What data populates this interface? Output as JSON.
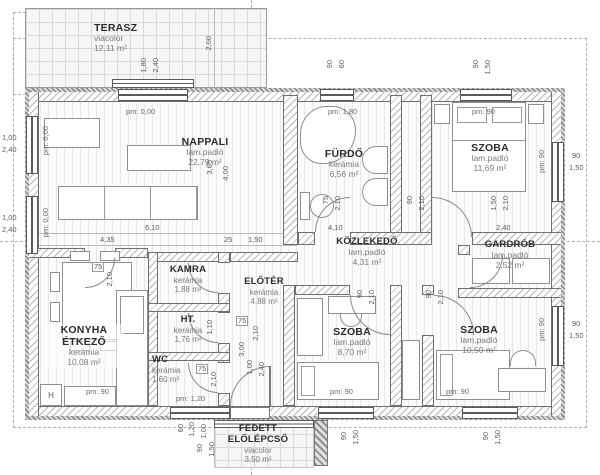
{
  "rooms": {
    "terasz": {
      "name": "TERASZ",
      "floor": "viacolor",
      "area": "12,11 m²"
    },
    "nappali": {
      "name": "NAPPALI",
      "floor": "lam.padló",
      "area": "22,79 m²"
    },
    "furdo": {
      "name": "FÜRDŐ",
      "floor": "kerámia",
      "area": "6,56 m²"
    },
    "szoba_jobb_felso": {
      "name": "SZOBA",
      "floor": "lam.padló",
      "area": "11,69 m²"
    },
    "kozlekedo": {
      "name": "KÖZLEKEDŐ",
      "floor": "lam.padló",
      "area": "4,31 m²"
    },
    "gardrob": {
      "name": "GARDRÓB",
      "floor": "lam.padló",
      "area": "2,52 m²"
    },
    "kamra": {
      "name": "KAMRA",
      "floor": "kerámia",
      "area": "1,88 m²"
    },
    "eloter": {
      "name": "ELŐTÉR",
      "floor": "kerámia",
      "area": "4,88 m²"
    },
    "ht": {
      "name": "HT.",
      "floor": "kerámia",
      "area": "1,76 m²"
    },
    "wc": {
      "name": "WC",
      "floor": "kerámia",
      "area": "1,60 m²"
    },
    "konyha": {
      "name": "KONYHA",
      "name2": "ÉTKEZŐ",
      "floor": "kerámia",
      "area": "10,08 m²"
    },
    "szoba_kozep": {
      "name": "SZOBA",
      "floor": "lam.padló",
      "area": "8,70 m²"
    },
    "szoba_jobb_also": {
      "name": "SZOBA",
      "floor": "lam.padló",
      "area": "10,50 m²"
    },
    "lepcso": {
      "name": "FEDETT",
      "name2": "ELŐLÉPCSŐ",
      "floor": "viacolor",
      "area": "3,50 m²"
    }
  },
  "pm": {
    "p000": "pm: 0,00",
    "p180": "pm: 1,80",
    "p90": "pm: 90",
    "p120": "pm: 1,20"
  },
  "dims": {
    "d25": "25",
    "d60": "60",
    "d75": "75",
    "d90": "90",
    "d100": "1,00",
    "d110": "1,10",
    "d120": "1,20",
    "d150": "1,50",
    "d180": "1,80",
    "d200": "2,00",
    "d210": "2,10",
    "d240": "2,40",
    "d300": "3,00",
    "d350": "3,50",
    "d365": "3,65",
    "d400": "4,00",
    "d410": "4,10",
    "d435": "4,35",
    "d610": "6,10"
  },
  "markers": {
    "h": "H"
  }
}
